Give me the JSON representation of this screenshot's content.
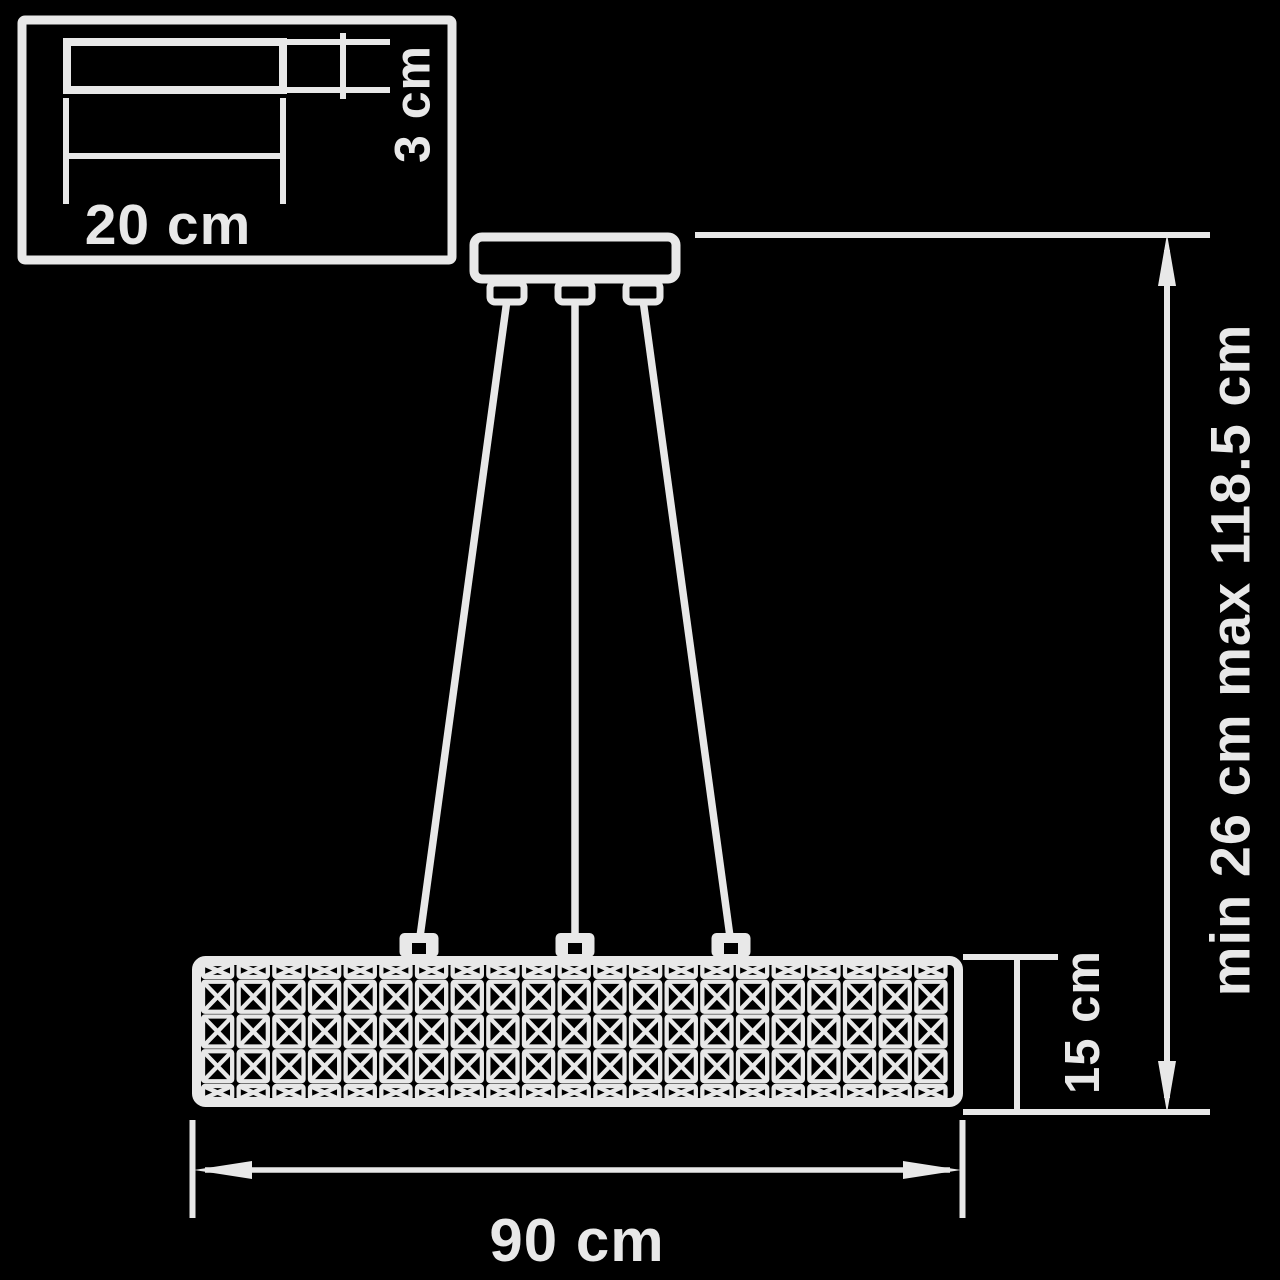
{
  "drawing": {
    "title": "pendant-lamp-dimension-diagram",
    "labels": {
      "mount_width": "20 cm",
      "mount_height": "3 cm",
      "shade_width": "90 cm",
      "shade_height": "15 cm",
      "suspension_height": "min 26 cm max 118.5 cm"
    },
    "colors": {
      "background": "#000000",
      "line": "#e8e8e8"
    },
    "suspension": {
      "wires": 3
    },
    "shade_pattern": {
      "motif": "crossed-square",
      "columns": 21,
      "full_rows": 3,
      "half_row_top": true,
      "half_row_bottom": true
    }
  }
}
